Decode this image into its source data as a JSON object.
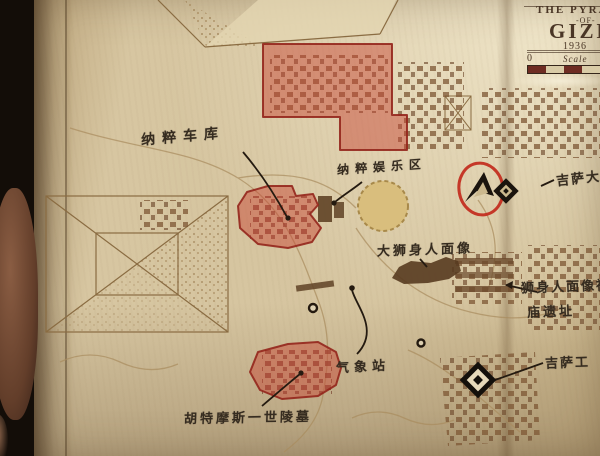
{
  "title_block": {
    "line1": "THE PYRAM",
    "separator": "-OF-",
    "title": "GIZE",
    "year": "1936",
    "scale_zero": "0",
    "scale_label": "Scale"
  },
  "labels": {
    "nazi_garage": "纳粹车库",
    "nazi_recreation": "纳粹娱乐区",
    "great_sphinx": "大狮身人面像",
    "sphinx_temple_line1": "狮身人面像神",
    "sphinx_temple_line2": "庙遗址",
    "giza_north": "吉萨大",
    "giza_worksite": "吉萨工",
    "weather_station": "气象站",
    "tomb_thutmose": "胡特摩斯一世陵墓"
  },
  "icons": {
    "player_marker": "navigation-arrow-icon",
    "player_highlight": "red-ellipse-outline",
    "waypoint_marker": "diamond-marker-icon",
    "zone_circle": "gold-circle-zone",
    "point_of_interest": "small-ring-marker"
  },
  "colors": {
    "zone_red_fill": "#c74434",
    "zone_red_border": "#942c20",
    "marker_red": "#c22a1c",
    "circle_gold": "#d9be7d",
    "paper": "#d5c49f",
    "ink_brown": "#7d5634",
    "annotation_ink": "#2a2118"
  }
}
